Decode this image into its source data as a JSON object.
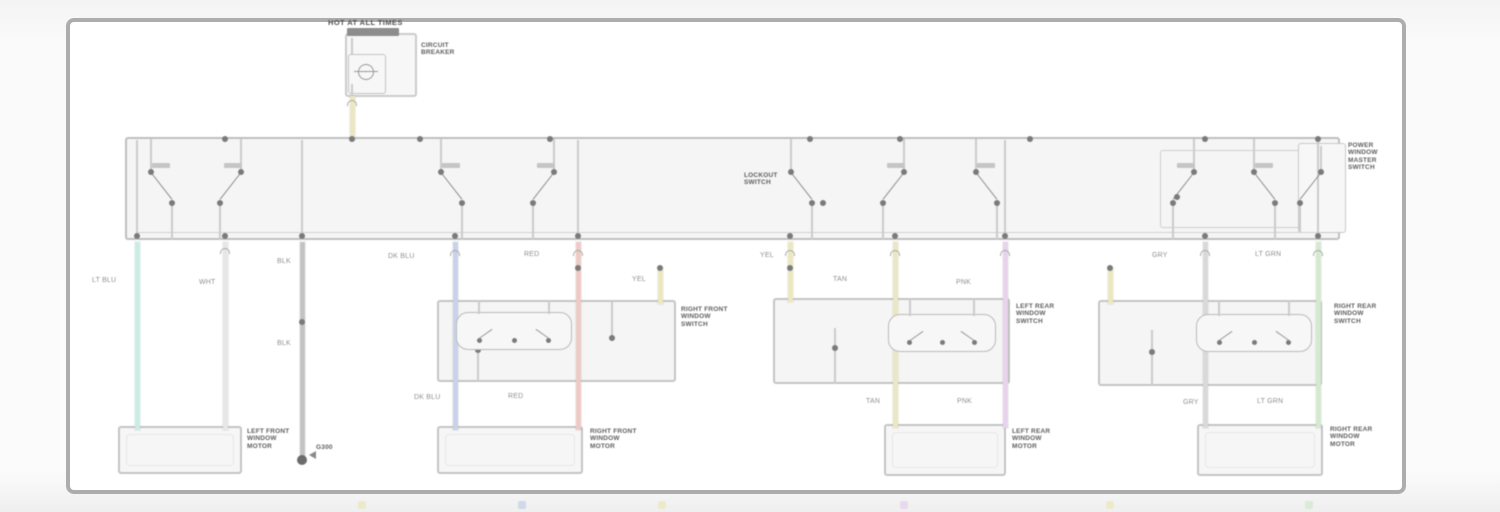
{
  "schematic": {
    "title": {
      "text": "HOT AT ALL TIMES"
    },
    "colors": {
      "frame_border": "#adadad",
      "box_border": "#c6c6c6",
      "line_gray": "#cfcfcf",
      "dot": "#7a7a7a",
      "label_gray": "#8f8f8f",
      "block_text": "#5c5c5c",
      "bus_bar": "#8e8e8e",
      "wire_lt_blu": "#cdf2ea",
      "wire_wht": "#ececec",
      "wire_blk": "#c7c7c7",
      "wire_dk_blu": "#ccd6ee",
      "wire_red": "#f3cfc8",
      "wire_yel": "#f1eec2",
      "wire_tan": "#f0ecc6",
      "wire_pnk": "#eed7f3",
      "wire_gry": "#dedede",
      "wire_lt_grn": "#d9efd5"
    },
    "boxes": [
      {
        "name": "fuse-block-box",
        "x": 345,
        "y": 33,
        "w": 72,
        "h": 64,
        "fill": "#fdfdfd",
        "border": "#cfcfcf",
        "bw": 2
      },
      {
        "name": "circuit-breaker-inner-box",
        "x": 348,
        "y": 54,
        "w": 38,
        "h": 40,
        "fill": "#fdfdfd",
        "border": "#c8c8c8",
        "bw": 1.5
      },
      {
        "name": "master-switch-box",
        "x": 125,
        "y": 137,
        "w": 1215,
        "h": 103,
        "fill": "#fbfbfb",
        "border": "#c2c2c2",
        "bw": 2.5
      },
      {
        "name": "master-inner-box",
        "x": 1160,
        "y": 150,
        "w": 172,
        "h": 78,
        "fill": "transparent",
        "border": "#d2d2d2",
        "bw": 1.5
      },
      {
        "name": "master-right-box",
        "x": 1298,
        "y": 143,
        "w": 48,
        "h": 90,
        "fill": "#fdfdfd",
        "border": "#cccccc",
        "bw": 1.5
      },
      {
        "name": "right-front-switch-box",
        "x": 437,
        "y": 300,
        "w": 239,
        "h": 82,
        "fill": "#fbfbfb",
        "border": "#c8c8c8",
        "bw": 2
      },
      {
        "name": "left-rear-switch-box",
        "x": 773,
        "y": 298,
        "w": 237,
        "h": 86,
        "fill": "#fbfbfb",
        "border": "#c8c8c8",
        "bw": 2
      },
      {
        "name": "right-rear-switch-box",
        "x": 1098,
        "y": 300,
        "w": 224,
        "h": 86,
        "fill": "#fbfbfb",
        "border": "#c8c8c8",
        "bw": 2
      },
      {
        "name": "left-front-motor-box",
        "x": 118,
        "y": 426,
        "w": 124,
        "h": 48,
        "fill": "#fcfcfc",
        "border": "#c8c8c8",
        "bw": 2,
        "inner": true
      },
      {
        "name": "right-front-motor-box",
        "x": 437,
        "y": 426,
        "w": 146,
        "h": 48,
        "fill": "#fcfcfc",
        "border": "#c8c8c8",
        "bw": 2,
        "inner": true
      },
      {
        "name": "left-rear-motor-box",
        "x": 884,
        "y": 424,
        "w": 122,
        "h": 52,
        "fill": "#fcfcfc",
        "border": "#c8c8c8",
        "bw": 2,
        "inner": true
      },
      {
        "name": "right-rear-motor-box",
        "x": 1197,
        "y": 424,
        "w": 126,
        "h": 52,
        "fill": "#fcfcfc",
        "border": "#c8c8c8",
        "bw": 2,
        "inner": true
      }
    ],
    "bus_bar": {
      "name": "fuse-block-bus-bar",
      "x": 347,
      "y": 28,
      "w": 52,
      "h": 8
    },
    "breaker_circle": {
      "name": "circuit-breaker-symbol",
      "x": 358,
      "y": 64,
      "d": 16
    },
    "inner_hline": {
      "x": 137,
      "y": 232,
      "w": 1181
    },
    "wires": [
      {
        "name": "breaker-feed-wire",
        "color": "wire_tan",
        "x": 352,
        "y1": 96,
        "y2": 140
      },
      {
        "name": "lf-window-up-wire",
        "color": "wire_lt_blu",
        "x": 137,
        "y1": 242,
        "y2": 430
      },
      {
        "name": "lf-window-down-wire",
        "color": "wire_wht",
        "x": 225,
        "y1": 242,
        "y2": 430
      },
      {
        "name": "master-ground-wire",
        "color": "wire_blk",
        "x": 302,
        "y1": 242,
        "y2": 456
      },
      {
        "name": "rf-window-up-wire",
        "color": "wire_dk_blu",
        "x": 455,
        "y1": 242,
        "y2": 430
      },
      {
        "name": "rf-window-down-wire",
        "color": "wire_red",
        "x": 578,
        "y1": 242,
        "y2": 430
      },
      {
        "name": "rf-switch-feed-wire",
        "color": "wire_yel",
        "x": 660,
        "y1": 268,
        "y2": 304
      },
      {
        "name": "lr-switch-feed-wire",
        "color": "wire_yel",
        "x": 790,
        "y1": 242,
        "y2": 302
      },
      {
        "name": "lr-window-up-wire",
        "color": "wire_tan",
        "x": 895,
        "y1": 242,
        "y2": 428
      },
      {
        "name": "lr-window-down-wire",
        "color": "wire_pnk",
        "x": 1005,
        "y1": 242,
        "y2": 428
      },
      {
        "name": "rr-switch-feed-wire",
        "color": "wire_yel",
        "x": 1110,
        "y1": 268,
        "y2": 304
      },
      {
        "name": "rr-window-up-wire",
        "color": "wire_gry",
        "x": 1205,
        "y1": 242,
        "y2": 428
      },
      {
        "name": "rr-window-down-wire",
        "color": "wire_lt_grn",
        "x": 1318,
        "y1": 242,
        "y2": 428
      }
    ],
    "gray_stubs": [
      [
        352,
        38,
        16
      ],
      [
        352,
        84,
        12
      ],
      [
        137,
        140,
        100
      ],
      [
        302,
        140,
        100
      ],
      [
        578,
        140,
        100
      ],
      [
        1005,
        140,
        100
      ],
      [
        1318,
        140,
        100
      ],
      [
        455,
        302,
        12
      ],
      [
        578,
        302,
        80
      ],
      [
        895,
        302,
        14
      ],
      [
        1005,
        302,
        82
      ],
      [
        1205,
        302,
        84
      ],
      [
        478,
        348,
        34
      ],
      [
        612,
        302,
        38
      ],
      [
        835,
        328,
        56
      ],
      [
        1152,
        330,
        56
      ]
    ],
    "dots": [
      [
        352,
        139
      ],
      [
        225,
        139
      ],
      [
        420,
        139
      ],
      [
        550,
        139
      ],
      [
        810,
        139
      ],
      [
        900,
        139
      ],
      [
        1030,
        139
      ],
      [
        1205,
        139
      ],
      [
        1318,
        139
      ],
      [
        137,
        236
      ],
      [
        225,
        236
      ],
      [
        302,
        236
      ],
      [
        455,
        236
      ],
      [
        578,
        236
      ],
      [
        790,
        236
      ],
      [
        895,
        236
      ],
      [
        1005,
        236
      ],
      [
        1205,
        236
      ],
      [
        1318,
        236
      ],
      [
        578,
        268
      ],
      [
        660,
        268
      ],
      [
        790,
        268
      ],
      [
        1110,
        268
      ],
      [
        302,
        322
      ],
      [
        478,
        350
      ],
      [
        612,
        338
      ],
      [
        835,
        348
      ],
      [
        1152,
        352
      ],
      [
        823,
        203
      ],
      [
        1177,
        197
      ]
    ],
    "ground_dot": [
      302,
      460
    ],
    "connectors": [
      [
        352,
        100
      ],
      [
        225,
        248
      ],
      [
        455,
        250
      ],
      [
        578,
        250
      ],
      [
        790,
        250
      ],
      [
        895,
        250
      ],
      [
        1005,
        250
      ],
      [
        1205,
        250
      ],
      [
        1318,
        250
      ]
    ],
    "switches": [
      {
        "cx": 160,
        "flip": 0
      },
      {
        "cx": 232,
        "flip": 1
      },
      {
        "cx": 450,
        "flip": 0
      },
      {
        "cx": 545,
        "flip": 1
      },
      {
        "cx": 800,
        "flip": 0
      },
      {
        "cx": 895,
        "flip": 1
      },
      {
        "cx": 985,
        "flip": 0
      },
      {
        "cx": 1185,
        "flip": 1
      },
      {
        "cx": 1263,
        "flip": 0
      },
      {
        "cx": 1312,
        "flip": 1,
        "y1": 146,
        "y2": 232
      }
    ],
    "term_marks": [
      [
        152,
        163
      ],
      [
        224,
        163
      ],
      [
        442,
        163
      ],
      [
        537,
        163
      ],
      [
        887,
        163
      ],
      [
        977,
        163
      ],
      [
        1177,
        163
      ],
      [
        1255,
        163
      ]
    ],
    "rockers": [
      {
        "name": "rf-switch-rocker",
        "x": 456,
        "y": 312,
        "w": 116,
        "h": 38,
        "boxTop": 300
      },
      {
        "name": "lr-switch-rocker",
        "x": 888,
        "y": 314,
        "w": 108,
        "h": 38,
        "boxTop": 298
      },
      {
        "name": "rr-switch-rocker",
        "x": 1196,
        "y": 314,
        "w": 116,
        "h": 38,
        "boxTop": 300
      }
    ],
    "wire_labels": [
      {
        "t": "LT BLU",
        "x": 92,
        "y": 277
      },
      {
        "t": "WHT",
        "x": 199,
        "y": 279
      },
      {
        "t": "BLK",
        "x": 277,
        "y": 258
      },
      {
        "t": "BLK",
        "x": 277,
        "y": 340
      },
      {
        "t": "DK BLU",
        "x": 388,
        "y": 253
      },
      {
        "t": "RED",
        "x": 524,
        "y": 251
      },
      {
        "t": "YEL",
        "x": 632,
        "y": 276
      },
      {
        "t": "YEL",
        "x": 760,
        "y": 252
      },
      {
        "t": "TAN",
        "x": 833,
        "y": 276
      },
      {
        "t": "PNK",
        "x": 956,
        "y": 279
      },
      {
        "t": "GRY",
        "x": 1152,
        "y": 252
      },
      {
        "t": "LT GRN",
        "x": 1255,
        "y": 251
      },
      {
        "t": "DK BLU",
        "x": 414,
        "y": 394
      },
      {
        "t": "RED",
        "x": 508,
        "y": 393
      },
      {
        "t": "TAN",
        "x": 866,
        "y": 398
      },
      {
        "t": "PNK",
        "x": 957,
        "y": 398
      },
      {
        "t": "GRY",
        "x": 1183,
        "y": 399
      },
      {
        "t": "LT GRN",
        "x": 1257,
        "y": 398
      }
    ],
    "block_labels": [
      {
        "name": "circuit-breaker-label",
        "x": 421,
        "y": 42,
        "lines": [
          "CIRCUIT",
          "BREAKER"
        ]
      },
      {
        "name": "master-switch-label",
        "x": 1348,
        "y": 142,
        "lines": [
          "POWER",
          "WINDOW",
          "MASTER",
          "SWITCH"
        ]
      },
      {
        "name": "lockout-switch-label",
        "x": 744,
        "y": 172,
        "lines": [
          "LOCKOUT",
          "SWITCH"
        ]
      },
      {
        "name": "rf-switch-label",
        "x": 681,
        "y": 306,
        "lines": [
          "RIGHT FRONT",
          "WINDOW",
          "SWITCH"
        ]
      },
      {
        "name": "lr-switch-label",
        "x": 1016,
        "y": 303,
        "lines": [
          "LEFT REAR",
          "WINDOW",
          "SWITCH"
        ]
      },
      {
        "name": "rr-switch-label",
        "x": 1334,
        "y": 303,
        "lines": [
          "RIGHT REAR",
          "WINDOW",
          "SWITCH"
        ]
      },
      {
        "name": "lf-motor-label",
        "x": 247,
        "y": 428,
        "lines": [
          "LEFT FRONT",
          "WINDOW",
          "MOTOR"
        ]
      },
      {
        "name": "rf-motor-label",
        "x": 590,
        "y": 428,
        "lines": [
          "RIGHT FRONT",
          "WINDOW",
          "MOTOR"
        ]
      },
      {
        "name": "lr-motor-label",
        "x": 1012,
        "y": 428,
        "lines": [
          "LEFT REAR",
          "WINDOW",
          "MOTOR"
        ]
      },
      {
        "name": "rr-motor-label",
        "x": 1330,
        "y": 426,
        "lines": [
          "RIGHT REAR",
          "WINDOW",
          "MOTOR"
        ]
      },
      {
        "name": "ground-id-label",
        "x": 316,
        "y": 444,
        "lines": [
          "G300"
        ]
      }
    ],
    "smudges": [
      {
        "x": 358,
        "color": "wire_tan"
      },
      {
        "x": 518,
        "color": "wire_dk_blu"
      },
      {
        "x": 658,
        "color": "wire_yel"
      },
      {
        "x": 900,
        "color": "wire_pnk"
      },
      {
        "x": 1106,
        "color": "wire_yel"
      },
      {
        "x": 1305,
        "color": "wire_lt_grn"
      }
    ]
  }
}
